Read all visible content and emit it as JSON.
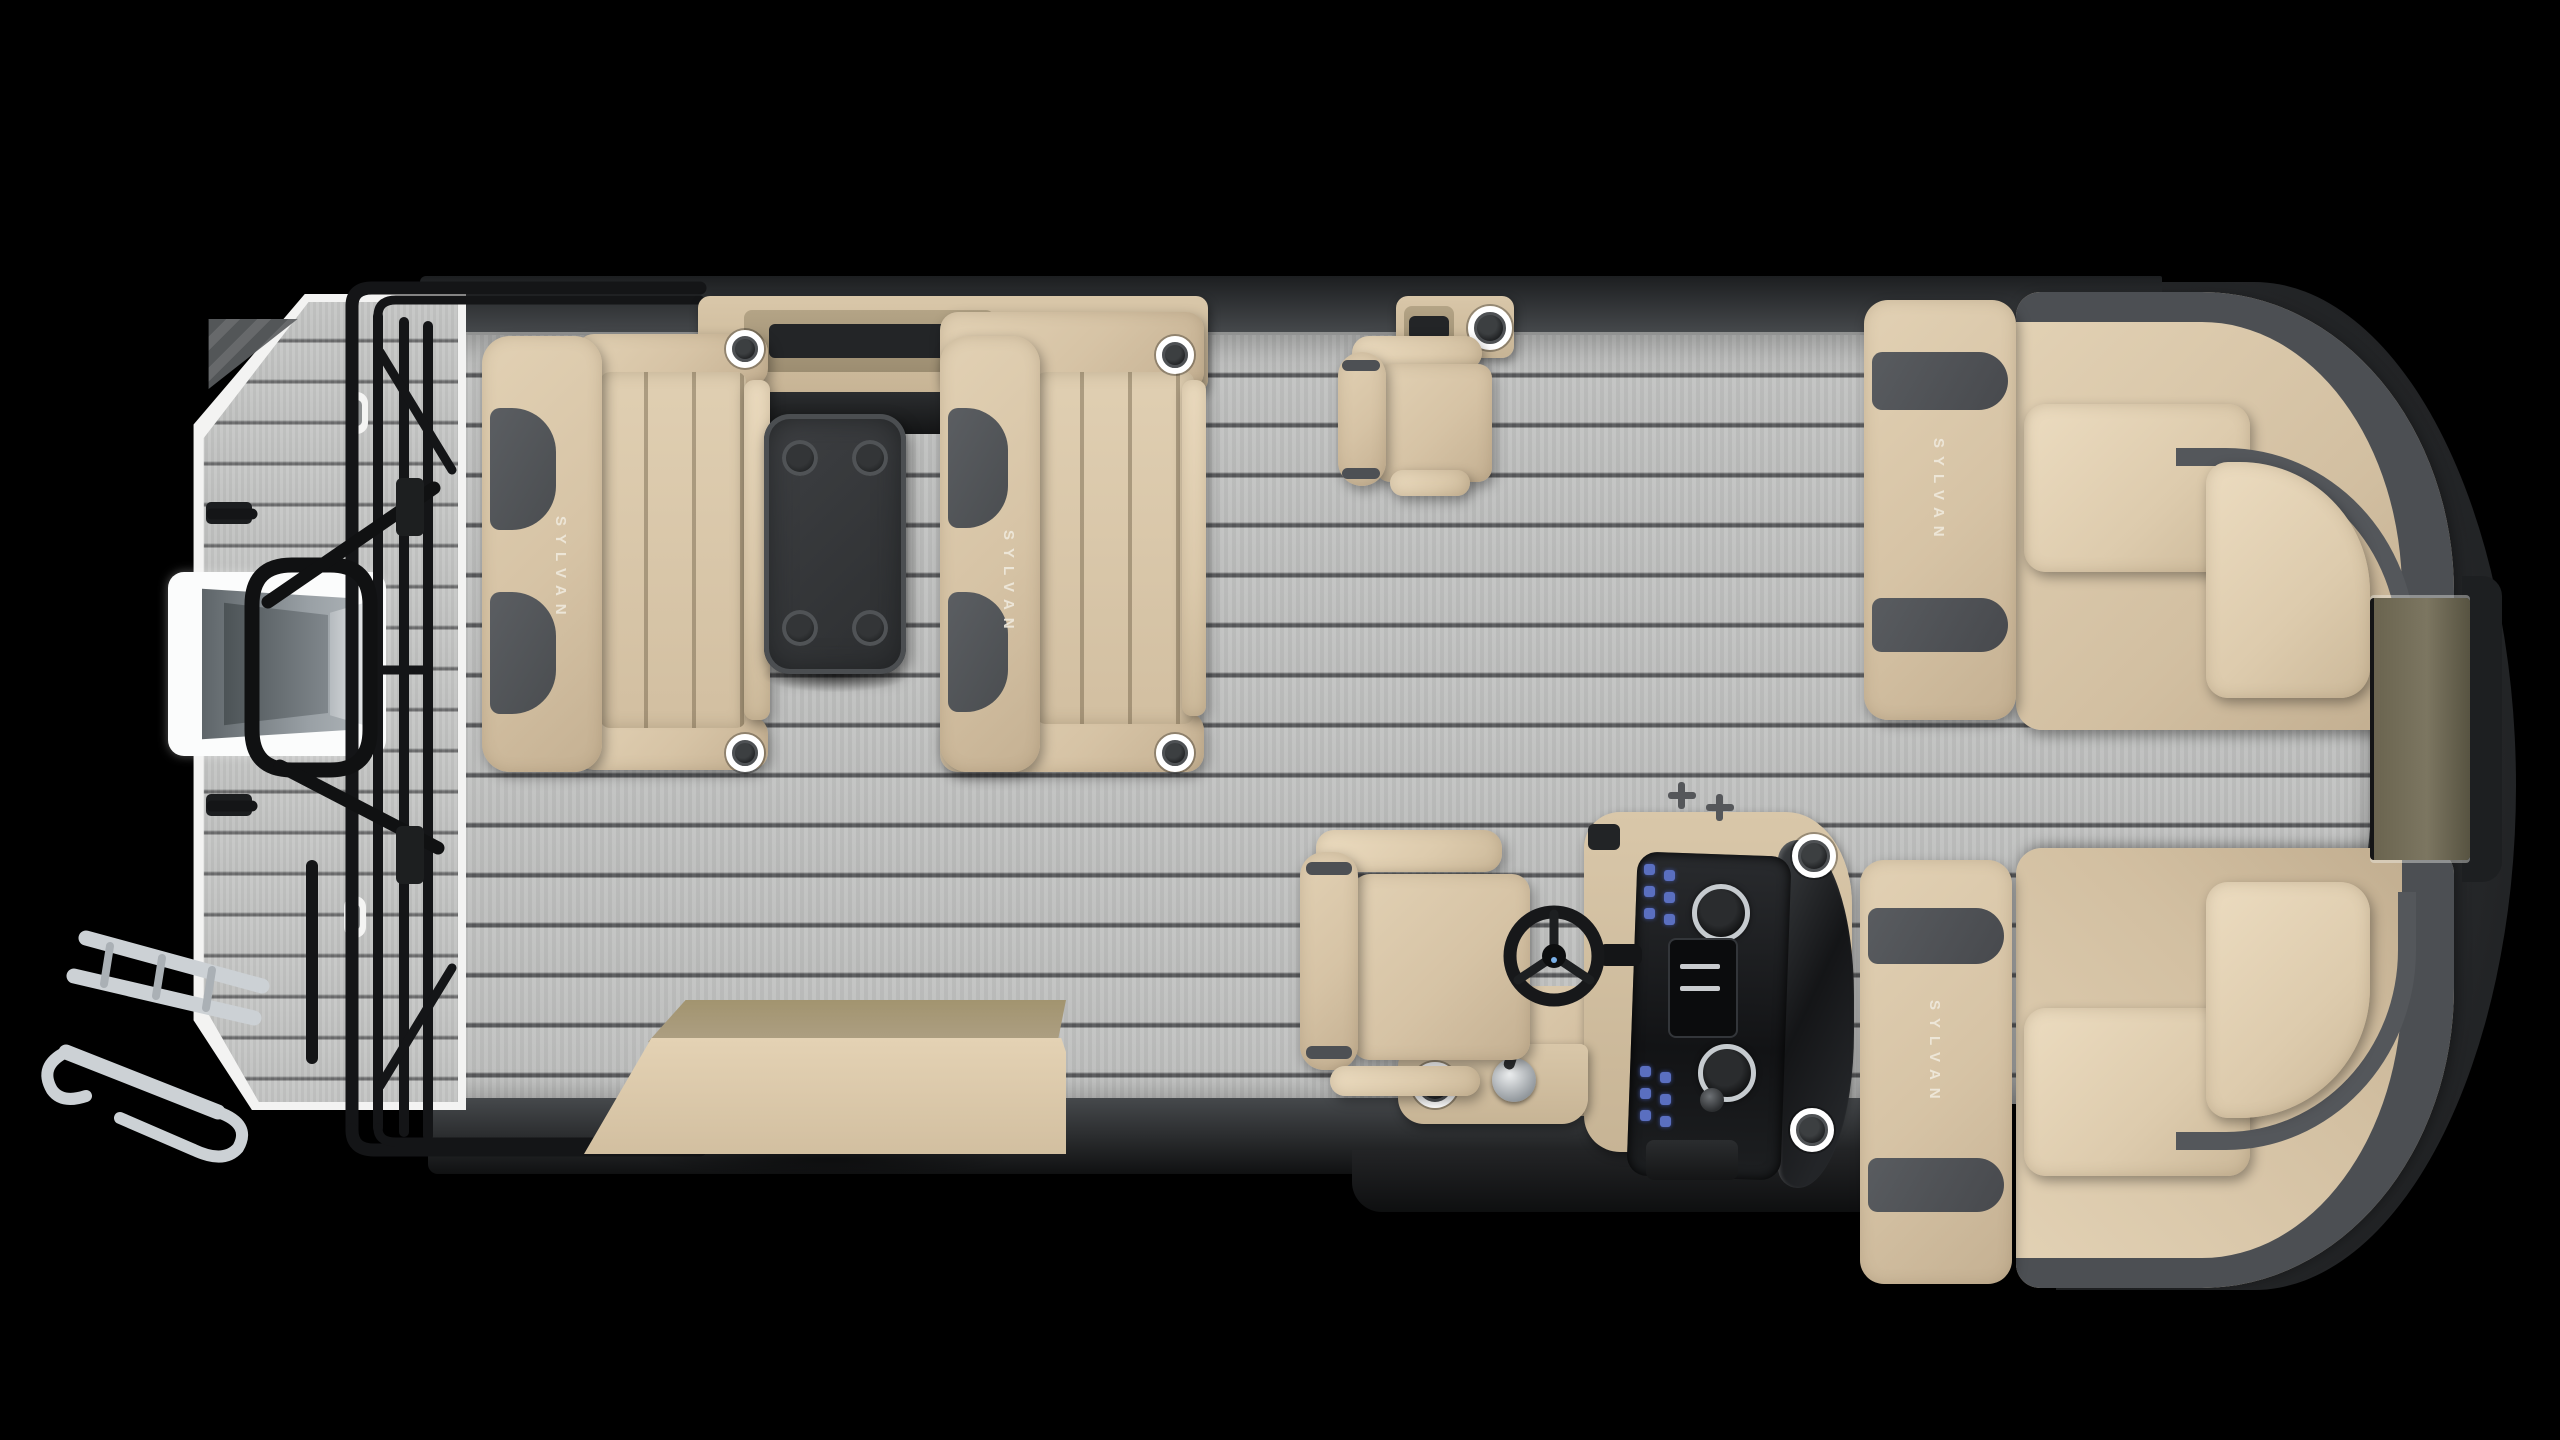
{
  "scene": {
    "background_color": "#000000",
    "view": "top-down pontoon boat floor plan render",
    "brand": "SYLVAN"
  },
  "labels": {
    "stern_bench_logo": "SYLVAN",
    "midship_bench_logo": "SYLVAN",
    "bow_port_lounge_logo": "SYLVAN",
    "bow_starboard_lounge_logo": "SYLVAN",
    "usb_port": "USB"
  },
  "colors": {
    "deck_gray": "#bfc0bf",
    "plank_line": "#58595b",
    "cushion_tan": "#d6c3a5",
    "cushion_light": "#e4d3b6",
    "cushion_shadow": "#bfab8d",
    "accent_charcoal": "#54575b",
    "gunwale_dark": "#26282a",
    "table_black": "#343638",
    "gate_olive": "#6a644f",
    "rail_black": "#151617",
    "ladder_chrome": "#ccd1d5",
    "motor_gray": "#8f969b",
    "led_ring_white": "#ffffff",
    "switch_blue": "#5a6fc0",
    "platform_trim_white": "#f3f3f2"
  },
  "components": {
    "stern": [
      "swim-platform",
      "outboard-motor",
      "boarding-ladder",
      "ski-tow-arch",
      "stern-fence"
    ],
    "midship": [
      "aft-facing-bench",
      "forward-facing-bench",
      "removable-table",
      "gunwale-storage-console",
      "usb-port",
      "storage-bench",
      "companion-chair",
      "companion-gunwale-console"
    ],
    "helm": [
      "captain-chair",
      "steering-wheel",
      "helm-console",
      "instrument-dash",
      "throttle",
      "windscreen",
      "dock-cleats"
    ],
    "bow": [
      "port-bow-lounge",
      "starboard-bow-lounge",
      "bow-gate"
    ]
  }
}
